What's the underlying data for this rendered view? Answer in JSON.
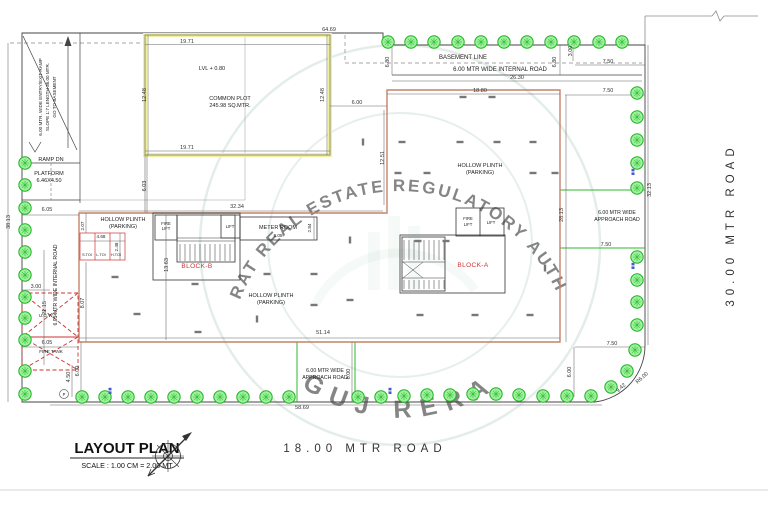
{
  "document": {
    "title": "LAYOUT PLAN",
    "scale_note": "SCALE : 1.00 CM = 2.00 MT"
  },
  "watermark": {
    "arc_text": "GUJARAT REAL ESTATE REGULATORY AUTHORITY",
    "bottom_text": "GUJ RERA",
    "color": "#8fb79f"
  },
  "roads": {
    "east": "30.00 MTR ROAD",
    "south": "18.00 MTR ROAD",
    "internal_top": "6.00 MTR WIDE INTERNAL ROAD",
    "internal_left": "6.05 MTR WIDE INTERNAL ROAD",
    "approach_wide": "6.00 MTR WIDE",
    "approach_road": "APPROACH ROAD",
    "basement_line": "BASEMENT LINE"
  },
  "areas": {
    "common_plot": "COMMON PLOT",
    "common_plot_area": "245.98 SQ.MTR.",
    "level": "LVL + 0.80",
    "hollow_plinth": "HOLLOW PLINTH",
    "parking": "(PARKING)",
    "ramp_line1": "6.00 MTR. WIDE ENTRY/EXIT RAMP",
    "ramp_line2": "SLOPE 1:7 LENGTH 36.00 MTR.",
    "ramp_line3": "GO TO BASEMENT",
    "ramp_dn": "RAMP DN",
    "platform": "PLATFORM",
    "platform_size": "6.46X4.50",
    "ugwt": "U.G.W.T.",
    "fire_tank": "FIRE TANK",
    "meter_room": "METER ROOM",
    "block_a": "BLOCK-A",
    "block_b": "BLOCK-B",
    "fire": "FIRE",
    "lift": "LIFT",
    "s_toi": "S.TOI",
    "l_toi": "L.TOI",
    "h_toi": "H.TOI",
    "p_marker": "P"
  },
  "dims": {
    "d64_69": "64.69",
    "d19_71": "19.71",
    "d12_48": "12.48",
    "d6_03": "6.03",
    "d6_00": "6.00",
    "d6_80": "6.80",
    "d3_00": "3.00",
    "d26_30": "26.30",
    "d18_80": "18.80",
    "d7_50": "7.50",
    "d12_51": "12.51",
    "d32_34": "32.34",
    "d2_07": "2.07",
    "d2_84": "2.84",
    "d8_05": "8.05",
    "d8_07": "8.07",
    "d13_63": "13.63",
    "d6_05": "6.05",
    "d21_15": "21.15",
    "d51_14": "51.14",
    "d58_69": "58.69",
    "d38_13": "38.13",
    "d32_13": "32.13",
    "d28_13": "28.13",
    "d4_50": "4.50",
    "d4_68": "4.68",
    "d2_48": "2.48",
    "d9_42": "9.42",
    "r6_00": "R6.00"
  },
  "colors": {
    "building_outline": "#c4836b",
    "tree_green": "#21b421",
    "road_green": "#2db82d",
    "highlight_yellow": "#f0f0a0",
    "marking_red": "#d03030",
    "label_red": "#cc3333",
    "watermark_green": "#8fb79f"
  },
  "site": {
    "trees": [
      [
        25,
        163
      ],
      [
        25,
        185
      ],
      [
        25,
        208
      ],
      [
        25,
        230
      ],
      [
        25,
        252
      ],
      [
        25,
        275
      ],
      [
        25,
        297
      ],
      [
        25,
        318
      ],
      [
        25,
        340
      ],
      [
        25,
        371
      ],
      [
        25,
        394
      ],
      [
        388,
        42
      ],
      [
        411,
        42
      ],
      [
        434,
        42
      ],
      [
        458,
        42
      ],
      [
        481,
        42
      ],
      [
        504,
        42
      ],
      [
        527,
        42
      ],
      [
        551,
        42
      ],
      [
        574,
        42
      ],
      [
        599,
        42
      ],
      [
        622,
        42
      ],
      [
        637,
        93
      ],
      [
        637,
        117
      ],
      [
        637,
        140
      ],
      [
        637,
        163
      ],
      [
        637,
        188
      ],
      [
        637,
        257
      ],
      [
        637,
        280
      ],
      [
        637,
        302
      ],
      [
        637,
        325
      ],
      [
        635,
        350
      ],
      [
        627,
        371
      ],
      [
        611,
        387
      ],
      [
        591,
        396
      ],
      [
        82,
        397
      ],
      [
        105,
        397
      ],
      [
        128,
        397
      ],
      [
        151,
        397
      ],
      [
        174,
        397
      ],
      [
        197,
        397
      ],
      [
        220,
        397
      ],
      [
        243,
        397
      ],
      [
        266,
        397
      ],
      [
        289,
        397
      ],
      [
        358,
        397
      ],
      [
        381,
        397
      ],
      [
        404,
        396
      ],
      [
        427,
        395
      ],
      [
        450,
        395
      ],
      [
        473,
        394
      ],
      [
        496,
        394
      ],
      [
        519,
        395
      ],
      [
        543,
        396
      ],
      [
        567,
        396
      ]
    ],
    "parking_ticks": [
      [
        463,
        97
      ],
      [
        492,
        97
      ],
      [
        402,
        142
      ],
      [
        460,
        142
      ],
      [
        497,
        142
      ],
      [
        533,
        142
      ],
      [
        363,
        142,
        "v"
      ],
      [
        398,
        173
      ],
      [
        427,
        173
      ],
      [
        533,
        173
      ],
      [
        555,
        173
      ],
      [
        418,
        241
      ],
      [
        446,
        241
      ],
      [
        545,
        268,
        "v"
      ],
      [
        115,
        277
      ],
      [
        195,
        284
      ],
      [
        267,
        274
      ],
      [
        314,
        274
      ],
      [
        137,
        314
      ],
      [
        198,
        332
      ],
      [
        314,
        305
      ],
      [
        257,
        319,
        "v"
      ],
      [
        350,
        240,
        "v"
      ],
      [
        350,
        300
      ],
      [
        420,
        315
      ],
      [
        475,
        315
      ],
      [
        530,
        315
      ]
    ],
    "tree_tags": [
      [
        110,
        391
      ],
      [
        390,
        391
      ],
      [
        633,
        172
      ],
      [
        633,
        266
      ]
    ]
  }
}
